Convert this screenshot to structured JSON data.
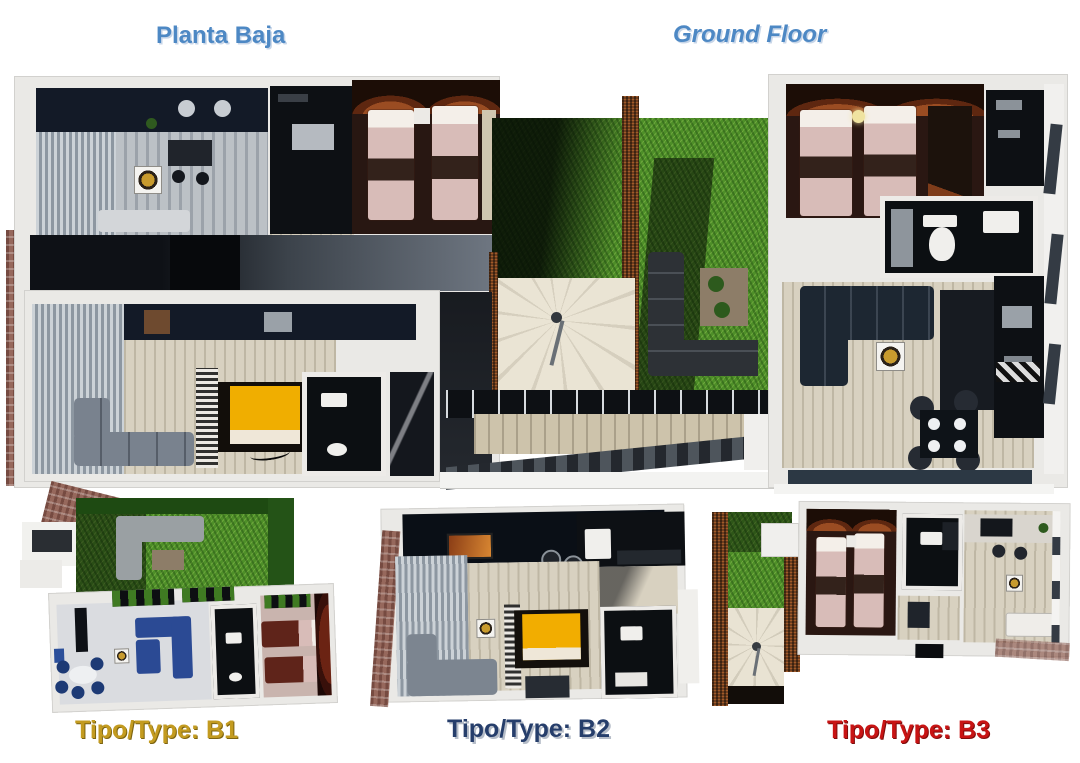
{
  "header": {
    "title_es": "Planta Baja",
    "title_en": "Ground Floor"
  },
  "units": {
    "b1": {
      "label": "Tipo/Type: B1"
    },
    "b2": {
      "label": "Tipo/Type: B2"
    },
    "b3": {
      "label": "Tipo/Type: B3"
    }
  },
  "colors": {
    "title_blue": "#4d88c4",
    "b1_gold": "#c39b20",
    "b2_navy": "#263e6b",
    "b3_red": "#c81414",
    "grass_green": "#4e8f28",
    "hedge_brown": "#6f3f1f",
    "floor_cream": "#d8d1c0",
    "bed_pink": "#d8bcb8",
    "bed_yellow": "#f0ae00",
    "sofa_blue": "#2b4a94",
    "wall_white": "#eae9e6"
  }
}
